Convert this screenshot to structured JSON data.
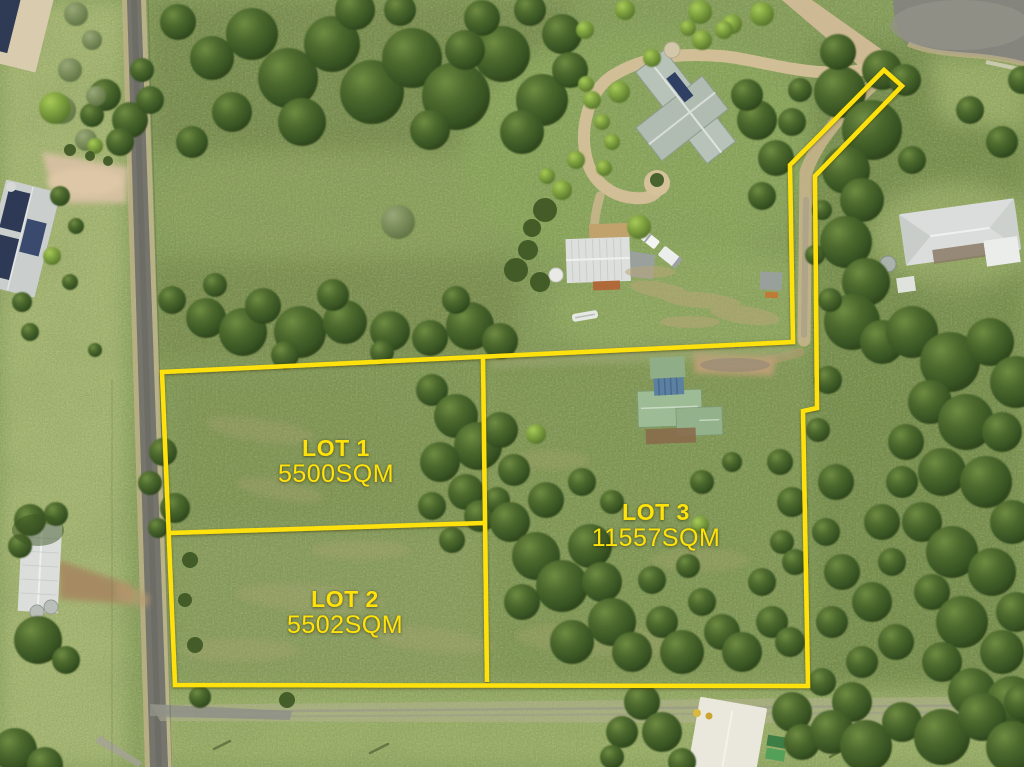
{
  "scene": {
    "annotation_color": "#FFE20A",
    "lots": [
      {
        "id": "lot-1",
        "name": "LOT 1",
        "area": "5500SQM"
      },
      {
        "id": "lot-2",
        "name": "LOT 2",
        "area": "5502SQM"
      },
      {
        "id": "lot-3",
        "name": "LOT 3",
        "area": "11557SQM"
      }
    ]
  }
}
